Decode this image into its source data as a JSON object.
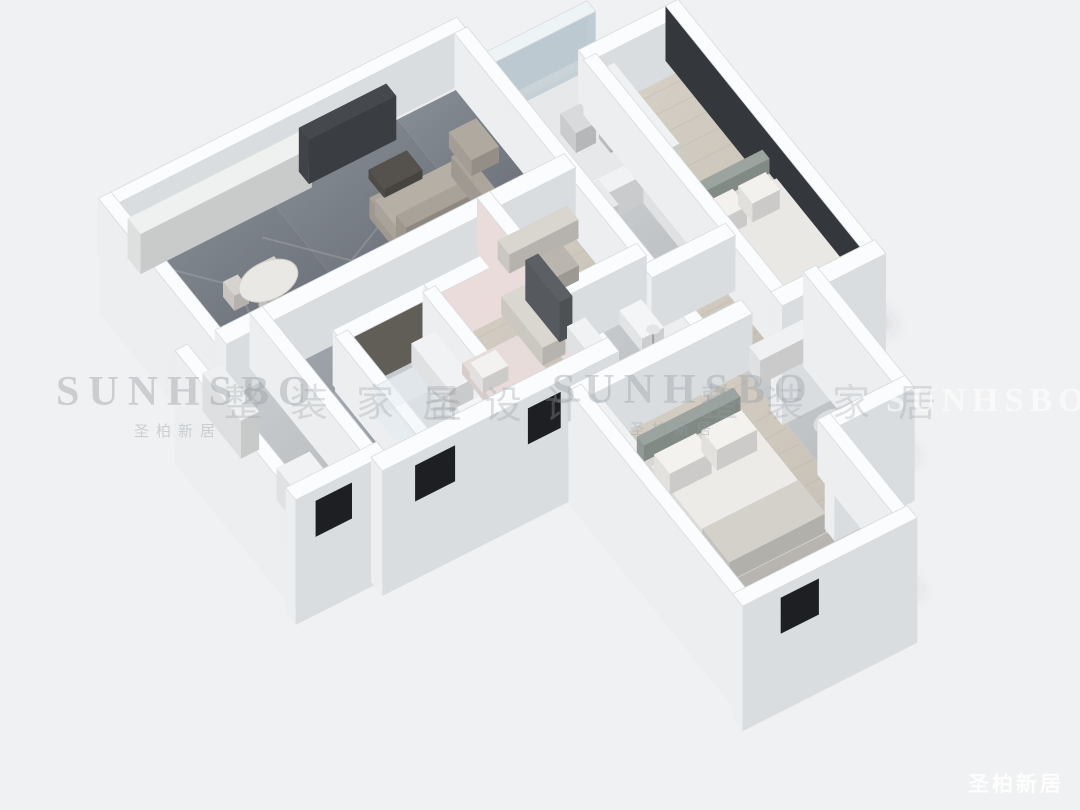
{
  "page": {
    "description": "3D axonometric dollhouse render of an apartment floor plan on a plain light background"
  },
  "watermarks": {
    "band": [
      {
        "text": "SUNHSBO",
        "sub": "圣柏新居"
      },
      {
        "text": "整装家居"
      },
      {
        "text": "圣设计"
      },
      {
        "text": "SUNHSBO",
        "sub": "圣柏新居"
      },
      {
        "text": "整装家居"
      },
      {
        "text": "SUNHSBO"
      }
    ],
    "corner": "圣柏新居"
  },
  "colors": {
    "background": "#f0f1f2",
    "wall_top": "#fbfcfd",
    "wall_edge": "#d8dbde",
    "face_light": "#eceef0",
    "face_shadow": "#d9dde0",
    "glass_dark": "#34383c",
    "accent_wall_dark": "#615e57",
    "accent_wall_pink": "#eadcdb",
    "window_dark": "#1d1f22",
    "marble_a": "#8a9098",
    "marble_b": "#61666e",
    "hall_a": "#a6acb2",
    "hall_b": "#8e949a",
    "wood_a": "#d7d1c7",
    "wood_b": "#c0baaf",
    "tile_a": "#cbcfd2",
    "tile_b": "#b6babd",
    "porch_floor": "#e6e8ea",
    "shadow": "rgba(70,75,80,0.12)"
  },
  "scene": {
    "rooms": [
      "balcony-laundry",
      "dining-area",
      "living-room",
      "entry-foyer",
      "glazed-porch",
      "hallway",
      "bathroom",
      "kids-bedroom",
      "study",
      "second-bathroom",
      "kitchen",
      "secondary-bedroom",
      "master-bedroom",
      "master-bathroom"
    ]
  }
}
